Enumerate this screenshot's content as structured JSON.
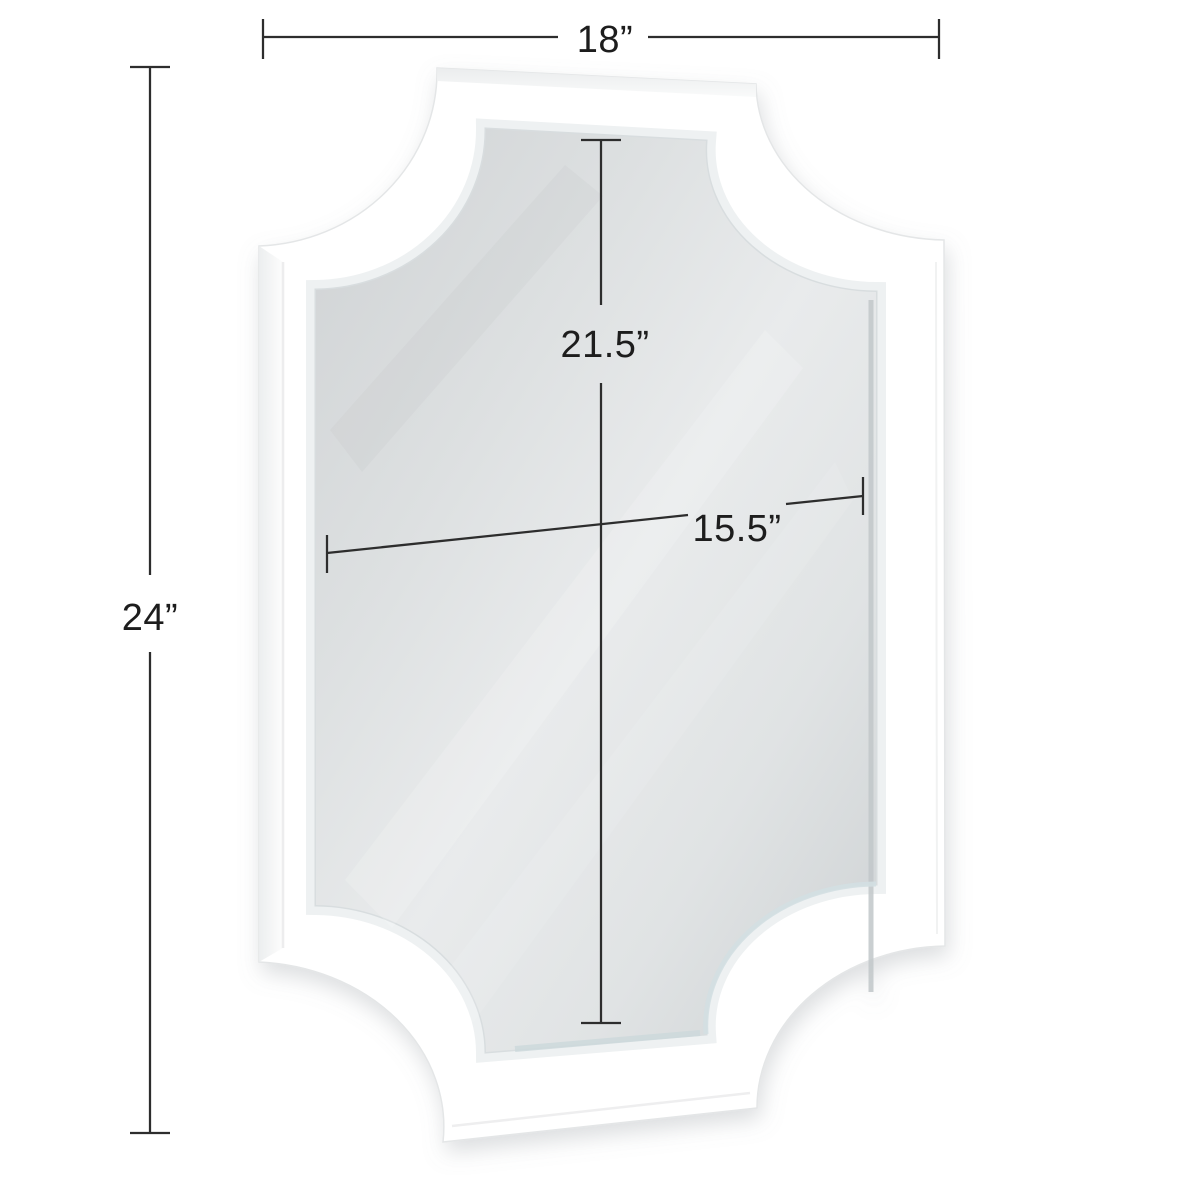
{
  "page": {
    "background": "#ffffff",
    "title": "White scalloped-corner wall mirror — dimension diagram"
  },
  "product": {
    "name": "Scalloped corner framed wall mirror",
    "frame_color": "#ffffff",
    "glass_color": "#e8eaec",
    "glass_edge_color": "#c1c7c9"
  },
  "style": {
    "line_color": "#2d2d2d",
    "label_color": "#1d1d1d"
  },
  "dimensions": {
    "overall_width": {
      "label": "18”",
      "value_inches": 18,
      "orientation": "horizontal",
      "position": "top"
    },
    "overall_height": {
      "label": "24”",
      "value_inches": 24,
      "orientation": "vertical",
      "position": "left"
    },
    "mirror_height": {
      "label": "21.5”",
      "value_inches": 21.5,
      "orientation": "vertical",
      "position": "center"
    },
    "mirror_width": {
      "label": "15.5”",
      "value_inches": 15.5,
      "orientation": "horizontal",
      "position": "center"
    }
  }
}
